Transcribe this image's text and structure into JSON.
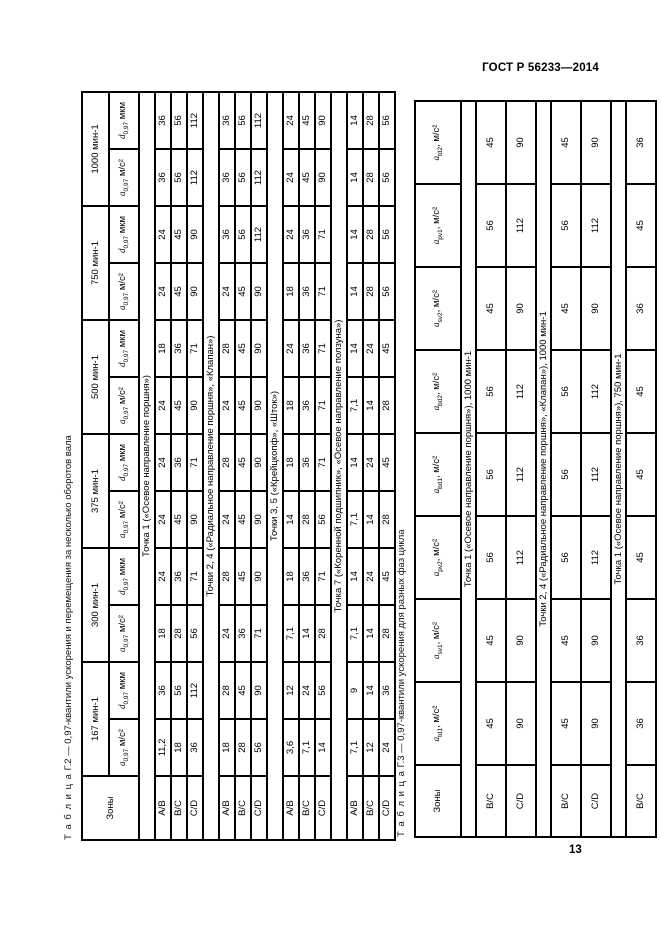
{
  "page": {
    "header_right": "ГОСТ Р 56233—2014",
    "page_number": "13"
  },
  "table_g2": {
    "title_word": "Т а б л и ц а",
    "title_rest": "  Г.2 — 0,97-квантили ускорения и перемещения за несколько оборотов вала",
    "zones_header": "Зоны",
    "speed_headers": [
      "167 мин-1",
      "300 мин-1",
      "375 мин-1",
      "500 мин-1",
      "750 мин-1",
      "1000 мин-1"
    ],
    "subheaders": {
      "accel": {
        "sym": "a",
        "sub": "0,97",
        "sep": " ",
        "unit": "м/с²"
      },
      "disp": {
        "sym": "d",
        "sub": "0,97",
        "sep": " ",
        "unit": "мкм"
      }
    },
    "sections": [
      {
        "label": "Точка 1 («Осевое направление поршня»)",
        "rows": [
          {
            "zone": "А/В",
            "values": [
              "11,2",
              "36",
              "18",
              "24",
              "24",
              "24",
              "24",
              "18",
              "24",
              "24",
              "36",
              "36"
            ]
          },
          {
            "zone": "В/С",
            "values": [
              "18",
              "56",
              "28",
              "36",
              "45",
              "36",
              "45",
              "36",
              "45",
              "45",
              "56",
              "56"
            ]
          },
          {
            "zone": "C/D",
            "values": [
              "36",
              "112",
              "56",
              "71",
              "90",
              "71",
              "90",
              "71",
              "90",
              "90",
              "112",
              "112"
            ]
          }
        ]
      },
      {
        "label": "Точки 2, 4 («Радиальное направление поршня», «Клапан»)",
        "rows": [
          {
            "zone": "А/В",
            "values": [
              "18",
              "28",
              "24",
              "28",
              "24",
              "28",
              "24",
              "28",
              "24",
              "36",
              "36",
              "36"
            ]
          },
          {
            "zone": "В/С",
            "values": [
              "28",
              "45",
              "36",
              "45",
              "45",
              "45",
              "45",
              "45",
              "45",
              "56",
              "56",
              "56"
            ]
          },
          {
            "zone": "C/D",
            "values": [
              "56",
              "90",
              "71",
              "90",
              "90",
              "90",
              "90",
              "90",
              "90",
              "112",
              "112",
              "112"
            ]
          }
        ]
      },
      {
        "label": "Точки 3, 5 («Крейцкопф», «Шток»)",
        "rows": [
          {
            "zone": "А/В",
            "values": [
              "3,6",
              "12",
              "7,1",
              "18",
              "14",
              "18",
              "18",
              "24",
              "18",
              "24",
              "24",
              "24"
            ]
          },
          {
            "zone": "В/С",
            "values": [
              "7,1",
              "24",
              "14",
              "36",
              "28",
              "36",
              "36",
              "36",
              "36",
              "36",
              "45",
              "45"
            ]
          },
          {
            "zone": "C/D",
            "values": [
              "14",
              "56",
              "28",
              "71",
              "56",
              "71",
              "71",
              "71",
              "71",
              "71",
              "90",
              "90"
            ]
          }
        ]
      },
      {
        "label": "Точка 7 («Коренной подшипник», «Осевое направление ползуна»)",
        "rows": [
          {
            "zone": "А/В",
            "values": [
              "7,1",
              "9",
              "7,1",
              "14",
              "7,1",
              "14",
              "7,1",
              "14",
              "14",
              "14",
              "14",
              "14"
            ]
          },
          {
            "zone": "В/С",
            "values": [
              "12",
              "14",
              "14",
              "24",
              "14",
              "24",
              "14",
              "24",
              "28",
              "28",
              "28",
              "28"
            ]
          },
          {
            "zone": "C/D",
            "values": [
              "24",
              "36",
              "28",
              "45",
              "28",
              "45",
              "28",
              "45",
              "56",
              "56",
              "56",
              "56"
            ]
          }
        ]
      }
    ]
  },
  "table_g3": {
    "title_word": "Т а б л и ц а",
    "title_rest": "  Г.3 — 0,97-квантили ускорения для разных фаз цикла",
    "zones_header": "Зоны",
    "col_headers": [
      {
        "sym": "a",
        "sub": "td1",
        "sep": ", ",
        "unit": "м/с²"
      },
      {
        "sym": "a",
        "sub": "sv1",
        "sep": ", ",
        "unit": "м/с²"
      },
      {
        "sym": "a",
        "sub": "pv2",
        "sep": ", ",
        "unit": "м/с²"
      },
      {
        "sym": "a",
        "sub": "bd1",
        "sep": ", ",
        "unit": "м/с²"
      },
      {
        "sym": "a",
        "sub": "bd2",
        "sep": ", ",
        "unit": "м/с²"
      },
      {
        "sym": "a",
        "sub": "sv2",
        "sep": ", ",
        "unit": "м/с²"
      },
      {
        "sym": "a",
        "sub": "pv1",
        "sep": ", ",
        "unit": "м/с²"
      },
      {
        "sym": "a",
        "sub": "td2",
        "sep": ", ",
        "unit": "м/с²"
      }
    ],
    "sections": [
      {
        "label": "Точка 1 («Осевое направление поршня»), 1000 мин-1",
        "rows": [
          {
            "zone": "В/С",
            "values": [
              "45",
              "45",
              "56",
              "56",
              "56",
              "45",
              "56",
              "45"
            ]
          },
          {
            "zone": "C/D",
            "values": [
              "90",
              "90",
              "112",
              "112",
              "112",
              "90",
              "112",
              "90"
            ]
          }
        ]
      },
      {
        "label": "Точки 2, 4 («Радиальное направление поршня», «Клапан»), 1000 мин-1",
        "rows": [
          {
            "zone": "В/С",
            "values": [
              "45",
              "45",
              "56",
              "56",
              "56",
              "45",
              "56",
              "45"
            ]
          },
          {
            "zone": "C/D",
            "values": [
              "90",
              "90",
              "112",
              "112",
              "112",
              "90",
              "112",
              "90"
            ]
          }
        ]
      },
      {
        "label": "Точка 1 («Осевое направление поршня»), 750 мин-1",
        "rows": [
          {
            "zone": "В/С",
            "values": [
              "36",
              "36",
              "45",
              "45",
              "45",
              "36",
              "45",
              "36"
            ]
          }
        ]
      }
    ]
  }
}
